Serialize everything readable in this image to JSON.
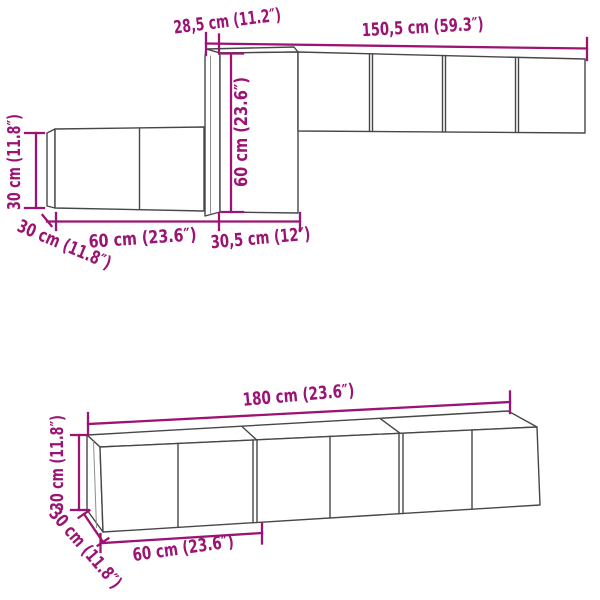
{
  "image_type": "furniture dimension diagram",
  "colors": {
    "dimension": "#9b1473",
    "outline": "#474747",
    "outline-light": "#8d8d8d",
    "background": "#ffffff"
  },
  "top_diagram": {
    "description": "wall-mounted TV cabinet composition",
    "labels": {
      "depth_top": "28,5 cm (11.2″)",
      "width_upper_row": "150,5 cm (59.3″)",
      "height_tall_cabinet": "60 cm (23.6″)",
      "height_left_cabinet": "30 cm (11.8″)",
      "depth_left_cabinet": "30 cm (11.8″)",
      "width_left_cabinet": "60 cm (23.6″)",
      "width_tall_cabinet": "30,5 cm (12″)"
    }
  },
  "bottom_diagram": {
    "description": "row of three wall-mounted TV cabinets",
    "labels": {
      "width_total": "180 cm (23.6″)",
      "height_cabinet": "30 cm (11.8″)",
      "depth_cabinet": "30 cm (11.8″)",
      "width_single_cabinet": "60 cm (23.6″)"
    }
  }
}
